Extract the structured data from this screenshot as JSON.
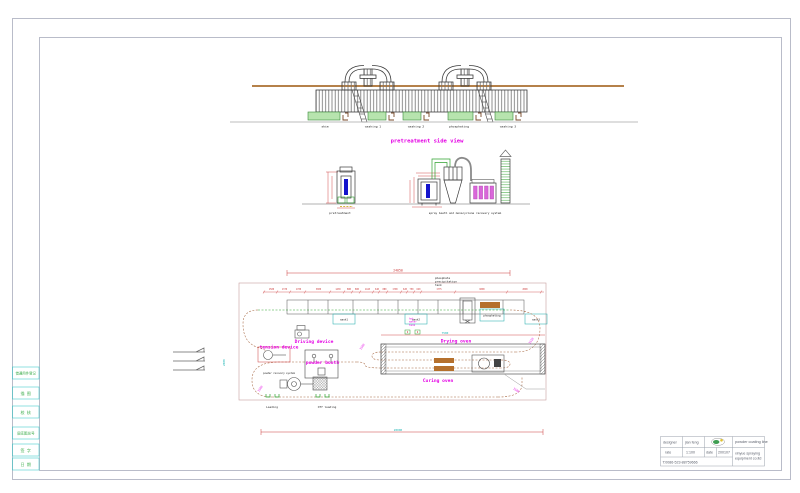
{
  "colors": {
    "magenta": "#e400e4",
    "dim_red": "#cc3a3a",
    "green": "#2fa12f",
    "cyan": "#1ab4b4",
    "blue": "#1414cc",
    "tan_beam": "#b5814a",
    "tank_fill": "#b7e4ae",
    "oven_bar": "#b5702d"
  },
  "frame": {
    "sidebar_items": [
      "借通用件登记",
      "描 图",
      "校 核",
      "旧底图总号",
      "签 字",
      "日 期"
    ]
  },
  "title_block": {
    "designer_label": "designer",
    "designer_value": "jian feng",
    "scale_label": "rate",
    "scale_value": "1:100",
    "date_label": "date",
    "date_value": "200107",
    "phone": "T:0086-523-88759666",
    "product": "powder coating line",
    "company_line1": "xinyue spraying",
    "company_line2": "equipment co.ltd"
  },
  "side_view": {
    "title": "pretreatment side view",
    "stations": [
      "skim",
      "washing 1",
      "washing 2",
      "phosphating",
      "washing 3"
    ]
  },
  "front_view": {
    "left_label": "pretreatment",
    "right_label": "spray booth and monocyclone recovery system"
  },
  "plan": {
    "overall_dim": "24050",
    "oven_dim": "7500",
    "bottom_dim": "20000",
    "left_dim": "2000",
    "dim_right": "1510",
    "dim_curve_mid": "1500",
    "dim_curve_left": "1500",
    "dim_curve_right": "1500",
    "chain_dims": [
      "1500",
      "1370",
      "1700",
      "3000",
      "1430",
      "880",
      "800",
      "1443",
      "640",
      "880",
      "1700",
      "620",
      "750",
      "620",
      "1775",
      "6000",
      "2090"
    ],
    "tanks": [
      "wash1",
      "wash2",
      "phosphating",
      "wash3"
    ],
    "note_phosphate_1": "phosphate",
    "note_phosphate_2": "precipitation",
    "note_phosphate_3": "tank",
    "note_hot_1": "hot",
    "note_hot_2": "water",
    "note_hot_3": "tank",
    "driving_device": "Driving device",
    "tension_device": "tension device",
    "powder_booth": "powder booth",
    "powder_recovery": "powder recovery system",
    "drying_oven": "Drying oven",
    "curing_oven": "Curing oven",
    "loading": "Loading",
    "off_loading": "Off loading"
  }
}
